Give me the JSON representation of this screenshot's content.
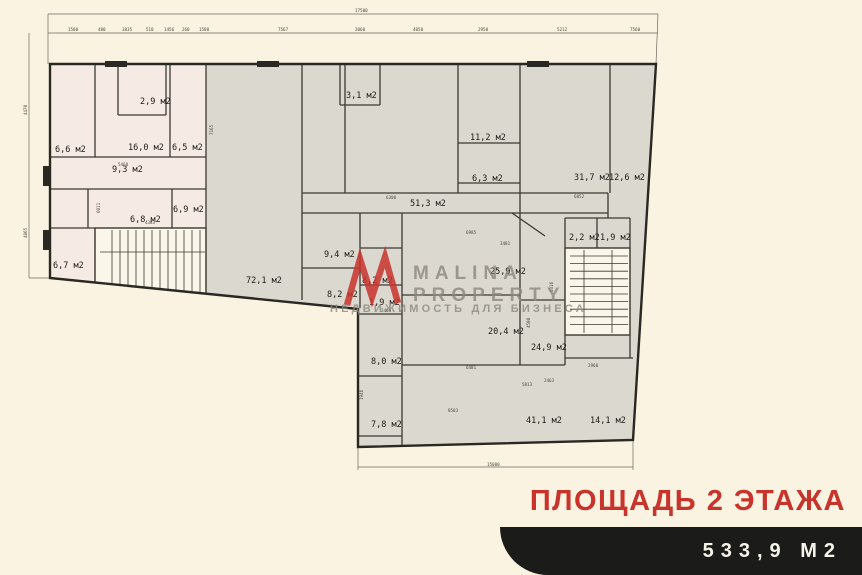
{
  "watermark": {
    "brand_top": "MALINA",
    "brand_bottom": "PROPERTY",
    "tagline": "НЕДВИЖИМОСТЬ ДЛЯ БИЗНЕСА"
  },
  "footer": {
    "title": "ПЛОЩАДЬ 2 ЭТАЖА",
    "area_badge": "533,9 М2"
  },
  "colors": {
    "paper": "#FAF3E2",
    "room_gray": "#DBD8CF",
    "room_pink": "#F6EAE5",
    "stair_white": "#FBF6EA",
    "wall": "#3b3931",
    "accent_red": "#C8342B",
    "banner_black": "#1B1B19",
    "watermark_gray": "#8d887e"
  },
  "plan": {
    "rooms": [
      {
        "t": "6,6 м2",
        "x": 55,
        "y": 152
      },
      {
        "t": "2,9 м2",
        "x": 140,
        "y": 104
      },
      {
        "t": "16,0 м2",
        "x": 128,
        "y": 150
      },
      {
        "t": "6,5 м2",
        "x": 172,
        "y": 150
      },
      {
        "t": "9,3 м2",
        "x": 112,
        "y": 172
      },
      {
        "t": "6,8 м2",
        "x": 130,
        "y": 222
      },
      {
        "t": "6,9 м2",
        "x": 173,
        "y": 212
      },
      {
        "t": "6,7 м2",
        "x": 53,
        "y": 268
      },
      {
        "t": "72,1 м2",
        "x": 246,
        "y": 283
      },
      {
        "t": "3,1 м2",
        "x": 346,
        "y": 98
      },
      {
        "t": "11,2 м2",
        "x": 470,
        "y": 140
      },
      {
        "t": "6,3 м2",
        "x": 472,
        "y": 181
      },
      {
        "t": "51,3 м2",
        "x": 410,
        "y": 206
      },
      {
        "t": "31,7 м2",
        "x": 574,
        "y": 180
      },
      {
        "t": "12,6 м2",
        "x": 609,
        "y": 180
      },
      {
        "t": "9,4 м2",
        "x": 324,
        "y": 257
      },
      {
        "t": "8,2 м2",
        "x": 362,
        "y": 283
      },
      {
        "t": "8,2 м2",
        "x": 327,
        "y": 297
      },
      {
        "t": "1,9 м2",
        "x": 369,
        "y": 305
      },
      {
        "t": "25,9 м2",
        "x": 490,
        "y": 274
      },
      {
        "t": "2,2 м2",
        "x": 569,
        "y": 240
      },
      {
        "t": "1,9 м2",
        "x": 600,
        "y": 240
      },
      {
        "t": "20,4 м2",
        "x": 488,
        "y": 334
      },
      {
        "t": "24,9 м2",
        "x": 531,
        "y": 350
      },
      {
        "t": "8,0 м2",
        "x": 371,
        "y": 364
      },
      {
        "t": "7,8 м2",
        "x": 371,
        "y": 427
      },
      {
        "t": "41,1 м2",
        "x": 526,
        "y": 423
      },
      {
        "t": "14,1 м2",
        "x": 590,
        "y": 423
      }
    ],
    "dims": [
      {
        "t": "17500",
        "x": 355,
        "y": 12
      },
      {
        "t": "1500",
        "x": 68,
        "y": 31
      },
      {
        "t": "480",
        "x": 98,
        "y": 31
      },
      {
        "t": "3835",
        "x": 122,
        "y": 31
      },
      {
        "t": "510",
        "x": 146,
        "y": 31
      },
      {
        "t": "1456",
        "x": 164,
        "y": 31
      },
      {
        "t": "260",
        "x": 182,
        "y": 31
      },
      {
        "t": "1580",
        "x": 199,
        "y": 31
      },
      {
        "t": "7567",
        "x": 278,
        "y": 31
      },
      {
        "t": "2060",
        "x": 355,
        "y": 31
      },
      {
        "t": "4050",
        "x": 413,
        "y": 31
      },
      {
        "t": "2950",
        "x": 478,
        "y": 31
      },
      {
        "t": "5212",
        "x": 557,
        "y": 31
      },
      {
        "t": "7560",
        "x": 630,
        "y": 31
      },
      {
        "t": "15000",
        "x": 487,
        "y": 466
      },
      {
        "t": "4470",
        "x": 27,
        "y": 115,
        "r": -90
      },
      {
        "t": "4865",
        "x": 27,
        "y": 238,
        "r": -90
      },
      {
        "t": "7165",
        "x": 213,
        "y": 135,
        "r": -90
      },
      {
        "t": "6011",
        "x": 100,
        "y": 213,
        "r": -90
      },
      {
        "t": "5460",
        "x": 118,
        "y": 166
      },
      {
        "t": "4383",
        "x": 145,
        "y": 224
      },
      {
        "t": "6300",
        "x": 386,
        "y": 199
      },
      {
        "t": "6985",
        "x": 466,
        "y": 234
      },
      {
        "t": "3481",
        "x": 500,
        "y": 245
      },
      {
        "t": "6852",
        "x": 574,
        "y": 198
      },
      {
        "t": "8316",
        "x": 553,
        "y": 292,
        "r": -90
      },
      {
        "t": "4500",
        "x": 530,
        "y": 328,
        "r": -90
      },
      {
        "t": "2400",
        "x": 381,
        "y": 312
      },
      {
        "t": "1946",
        "x": 363,
        "y": 400,
        "r": -90
      },
      {
        "t": "6481",
        "x": 466,
        "y": 369
      },
      {
        "t": "8503",
        "x": 448,
        "y": 412
      },
      {
        "t": "5813",
        "x": 522,
        "y": 386
      },
      {
        "t": "2463",
        "x": 544,
        "y": 382
      },
      {
        "t": "2960",
        "x": 588,
        "y": 367
      }
    ]
  }
}
